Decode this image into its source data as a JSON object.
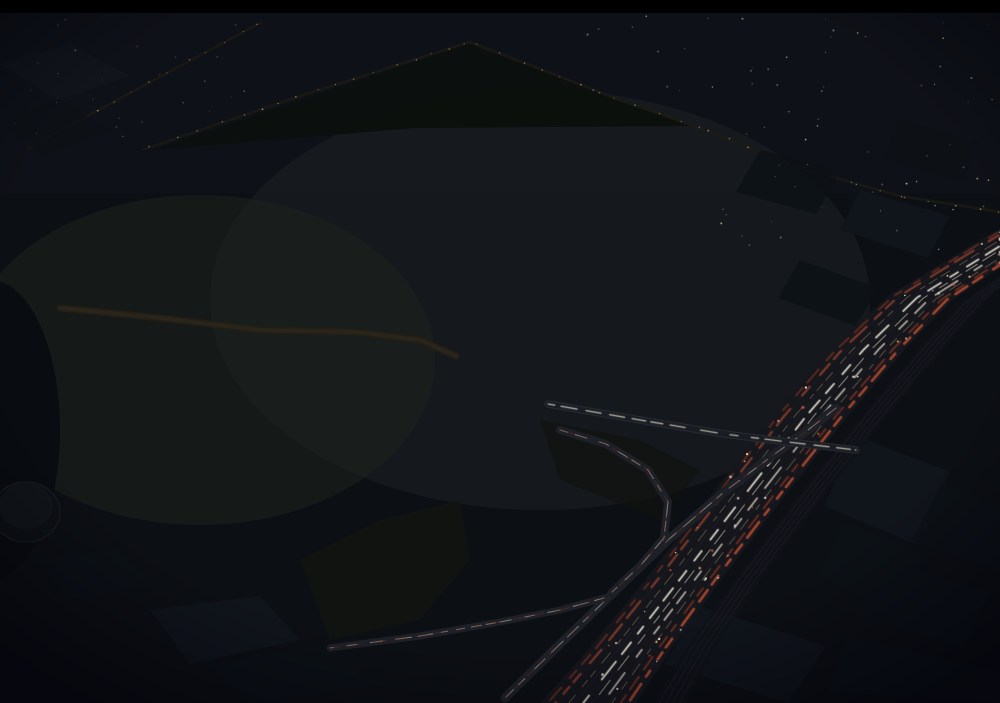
{
  "scene": {
    "label": "night-aerial-rendering-of-shopping-mall-complex"
  },
  "palette": {
    "letterbox": "#000000",
    "ground_dark": "#0c0f14",
    "ground_mid": "#14171d",
    "grass_dark": "#0c100d",
    "city_block": "#11151c",
    "city_block_dark": "#0d1117",
    "mall_roof_light": "#b4bac2",
    "mall_roof_mid": "#99a0aa",
    "mall_roof_dark": "#7c838d",
    "skylight_core": "#fffef4",
    "skylight_warm": "#f6ecc6",
    "skylight_gold": "#cdb87e",
    "skylight_grid": "#a8904e",
    "skylight_blue": "#c9dcec",
    "glow_white": "#ffffff",
    "glow_warm": "#ffeebb",
    "beam": "#eef3ff",
    "hotel_facade": "#2e3138",
    "hotel_roof": "#bcc1c8",
    "window_warm": "#ffe2a0",
    "window_cool": "#dfe8f2",
    "ramp_deck": "#cbc5b4",
    "ramp_deck_nw": "#8e9286",
    "ramp_amber": "#dda45f",
    "blue_roof_light": "#4a5572",
    "blue_roof_dark": "#252c44",
    "lot_ground": "#3a3f37",
    "lot_ground_lit": "#6b6350",
    "road_warm": "#241f16",
    "streetlight": "#f4c678",
    "headlight": "#e8e2d2",
    "taillight": "#b04a2e",
    "taillight_dim": "#7d3322",
    "tree_dark": "#0e130b",
    "tree_mid": "#16200f",
    "tree_lite": "#1d2a14",
    "freeway_asphalt": "#16171c",
    "rail_band": "#0f1217",
    "car_colors": [
      "#d9d8d2",
      "#9aa0a4",
      "#585e64",
      "#b04a3a",
      "#c8b87c",
      "#3c4248",
      "#e8e6da"
    ]
  },
  "procedural": {
    "seed": 12,
    "city_window_dots": 90,
    "city_window_dots_left": 25,
    "freeway_car_dots": 48,
    "parking_fill": 0.8
  }
}
